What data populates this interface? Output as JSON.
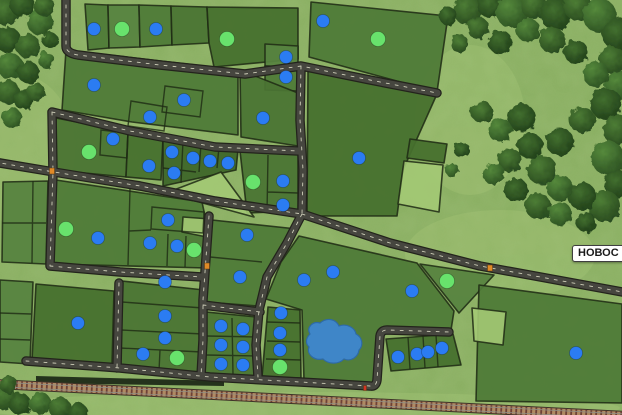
{
  "map_label": {
    "text": "НОВОС"
  },
  "markers": {
    "blue_color": "#2b7cf2",
    "green_color": "#68e26c",
    "blue": [
      [
        94,
        29
      ],
      [
        156,
        29
      ],
      [
        323,
        21
      ],
      [
        94,
        85
      ],
      [
        184,
        100
      ],
      [
        150,
        117
      ],
      [
        286,
        57
      ],
      [
        286,
        77
      ],
      [
        263,
        118
      ],
      [
        113,
        139
      ],
      [
        172,
        152
      ],
      [
        193,
        158
      ],
      [
        210,
        161
      ],
      [
        228,
        163
      ],
      [
        149,
        166
      ],
      [
        174,
        173
      ],
      [
        359,
        158
      ],
      [
        283,
        181
      ],
      [
        283,
        205
      ],
      [
        168,
        220
      ],
      [
        98,
        238
      ],
      [
        150,
        243
      ],
      [
        177,
        246
      ],
      [
        247,
        235
      ],
      [
        240,
        277
      ],
      [
        304,
        280
      ],
      [
        333,
        272
      ],
      [
        165,
        282
      ],
      [
        78,
        323
      ],
      [
        165,
        316
      ],
      [
        165,
        338
      ],
      [
        143,
        354
      ],
      [
        221,
        326
      ],
      [
        221,
        345
      ],
      [
        221,
        364
      ],
      [
        243,
        329
      ],
      [
        243,
        347
      ],
      [
        243,
        365
      ],
      [
        281,
        313
      ],
      [
        280,
        333
      ],
      [
        280,
        350
      ],
      [
        398,
        357
      ],
      [
        417,
        354
      ],
      [
        428,
        352
      ],
      [
        442,
        348
      ],
      [
        412,
        291
      ],
      [
        576,
        353
      ]
    ],
    "green": [
      [
        122,
        29
      ],
      [
        227,
        39
      ],
      [
        378,
        39
      ],
      [
        89,
        152
      ],
      [
        253,
        182
      ],
      [
        66,
        229
      ],
      [
        194,
        250
      ],
      [
        177,
        358
      ],
      [
        280,
        367
      ],
      [
        447,
        281
      ]
    ]
  },
  "road_signs": {
    "orange_color": "#e08a28",
    "red_color": "#d03324",
    "orange": [
      [
        52,
        171
      ],
      [
        490,
        268
      ],
      [
        207,
        266
      ]
    ],
    "red": [
      [
        365,
        388
      ]
    ]
  },
  "water": {
    "lake_color": "#3f86c8"
  }
}
